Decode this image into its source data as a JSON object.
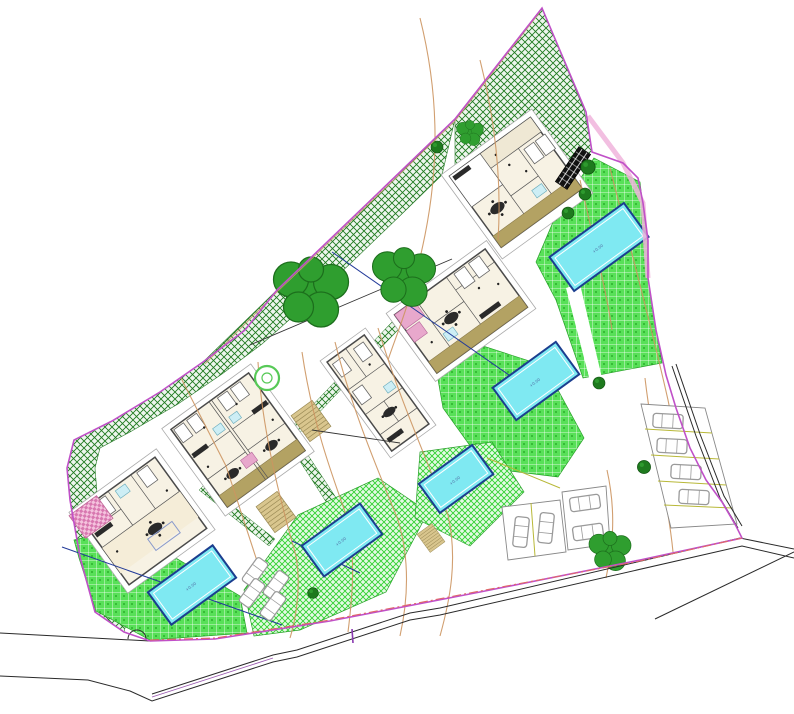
{
  "drawing": {
    "kind": "architectural-site-plan",
    "description": "Site plan of a villa development: five villa floor plans rotated on a sloping irregular plot, five swimming pools, grid-hatched lawns, cross-hatched preserved vegetation along the north-west boundary, parking bays with cars, contour lines, and a road along the south edge."
  },
  "labels": {
    "pool_level": "+0.00"
  },
  "palette": {
    "boundary": "#c050c8",
    "boundary_pink_band": "#f0b4dc",
    "dashdot_boundary": "#e06868",
    "preserved_hatch": "#1f7a1f",
    "lawn_grid": "#58e058",
    "lawn_diag": "#2fd02f",
    "pool_fill": "#7fe9f2",
    "pool_border": "#1b3e8f",
    "contour": "#cc9560",
    "road": "#2a2a2a",
    "car": "#9a9a9a",
    "parking_line": "#b8b838",
    "wall": "#4a4a4a",
    "terrace": "#b3a263",
    "accent_pink": "#e8a8cc",
    "tree_dark": "#1e7a1e",
    "tree_leafy": "#2f9e2f",
    "steps": "#d9c68e"
  },
  "features": {
    "villas": [
      {
        "id": "villa-1",
        "position": "north-east"
      },
      {
        "id": "villa-2",
        "position": "east-center"
      },
      {
        "id": "villa-3",
        "position": "center"
      },
      {
        "id": "villa-4",
        "position": "center-west (duplex)"
      },
      {
        "id": "villa-5",
        "position": "south-west"
      }
    ],
    "pools": 5,
    "parking": [
      {
        "id": "parking-east",
        "spaces": 4
      },
      {
        "id": "parking-center",
        "spaces": 4
      },
      {
        "id": "parking-west",
        "spaces": 4
      }
    ],
    "trees": {
      "large_canopy": 2,
      "small_round": 7,
      "ring_tree": 1,
      "shrub": 1
    },
    "roads": {
      "south_road": true,
      "east_access_road": true
    },
    "preserved_vegetation": "cross-hatched band along NW boundary and top wedge",
    "lawns": "bright green grid/diagonal hatched areas around pools"
  }
}
